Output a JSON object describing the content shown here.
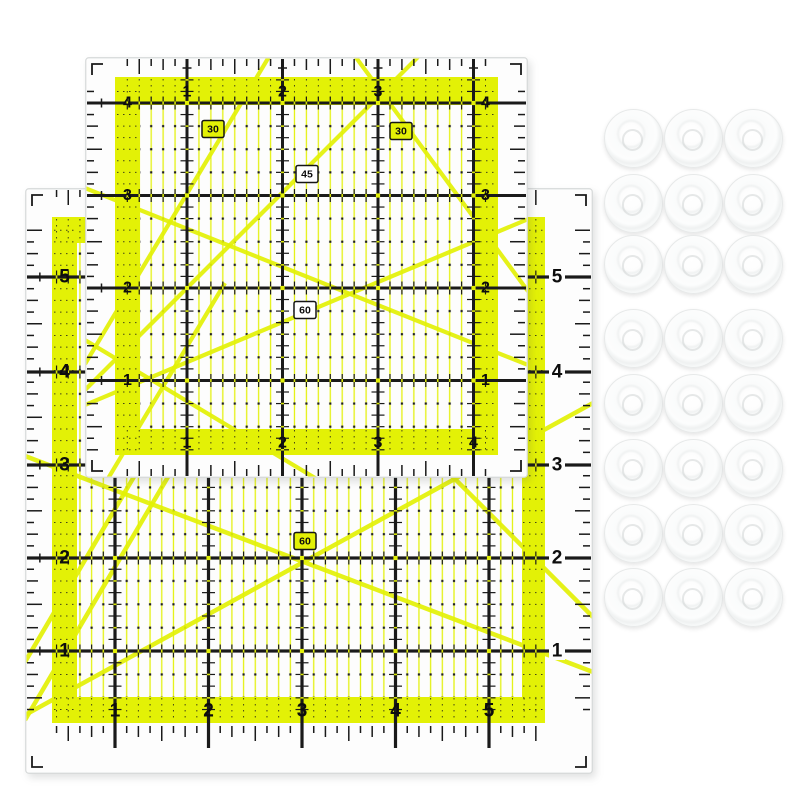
{
  "scene": {
    "width": 800,
    "height": 800,
    "background": "#ffffff",
    "description": "Two neon-yellow acrylic quilting rulers overlapping, with 24 white plastic discs arranged in a 3x8 grid on the right"
  },
  "colors": {
    "neon": "#e3f106",
    "ink": "#1a1a1a",
    "number": "#0d0d0d",
    "body": "#fdfdfd",
    "edge": "#d6d9d9",
    "dot": "#1f1f1f",
    "disc_edge": "#e7e9e9"
  },
  "rulers": [
    {
      "id": "large",
      "name": "large square quilting ruler",
      "pos": {
        "x": 25,
        "y": 188,
        "w": 568,
        "h": 586
      },
      "band": {
        "outer": [
          27,
          29,
          520,
          535
        ],
        "inner": [
          52,
          55,
          497,
          509
        ]
      },
      "grid": {
        "x_lines": [
          90,
          183.5,
          277,
          370.5,
          464
        ],
        "y_lines": [
          89,
          184,
          277,
          370,
          463
        ],
        "eighth_x": 11.69,
        "eighth_y": 11.69
      },
      "labels": {
        "top": [],
        "bottom": [
          "1",
          "2",
          "3",
          "4",
          "5"
        ],
        "left": [
          "5",
          "4",
          "3",
          "2",
          "1"
        ],
        "right": [
          "5",
          "4",
          "3",
          "2",
          "1"
        ],
        "font": 19
      },
      "angle_labels": [
        {
          "text": "60",
          "x": 280,
          "y": 353,
          "yellow": true
        }
      ],
      "diagonals": [
        [
          0,
          268,
          568,
          484
        ],
        [
          0,
          527,
          568,
          215
        ],
        [
          0,
          474,
          170,
          185
        ],
        [
          0,
          532,
          160,
          260
        ],
        [
          300,
          161,
          568,
          429
        ]
      ],
      "line_w": 3.2,
      "diag_w": 4.5,
      "bottom_anchor": "band",
      "right_numbers_x": 532
    },
    {
      "id": "small",
      "name": "small square quilting ruler",
      "pos": {
        "x": 85,
        "y": 57,
        "w": 443,
        "h": 421
      },
      "band": {
        "outer": [
          30,
          20,
          413,
          398
        ],
        "inner": [
          55,
          48,
          388,
          372
        ]
      },
      "grid": {
        "x_lines": [
          102,
          197.5,
          293,
          388.5
        ],
        "y_lines": [
          46,
          138.5,
          231,
          323.5
        ],
        "eighth_x": 11.94,
        "eighth_y": 11.56
      },
      "labels": {
        "top": [
          "1",
          "2",
          "3"
        ],
        "bottom": [
          "1",
          "2",
          "3",
          "4"
        ],
        "left": [
          "4",
          "3",
          "2",
          "1"
        ],
        "right": [
          "4",
          "3",
          "2",
          "1"
        ],
        "font": 16
      },
      "angle_labels": [
        {
          "text": "30",
          "x": 128,
          "y": 72,
          "yellow": true
        },
        {
          "text": "30",
          "x": 316,
          "y": 74,
          "yellow": true
        },
        {
          "text": "45",
          "x": 222,
          "y": 117,
          "yellow": false
        },
        {
          "text": "60",
          "x": 220,
          "y": 253,
          "yellow": false
        }
      ],
      "diagonals": [
        [
          0,
          307,
          200,
          -27
        ],
        [
          250,
          -28,
          448,
          241
        ],
        [
          0,
          333,
          360,
          -27
        ],
        [
          0,
          131,
          448,
          310
        ],
        [
          0,
          348,
          448,
          160
        ],
        [
          0,
          283,
          240,
          427
        ],
        [
          0,
          460,
          140,
          226
        ]
      ],
      "line_w": 3,
      "diag_w": 4.2,
      "bottom_anchor": "edge",
      "right_numbers_x": null
    }
  ],
  "discs": {
    "count": 24,
    "diameter": 57,
    "columns_x": [
      632,
      692,
      752
    ],
    "rows_y": [
      137,
      202,
      263,
      337,
      402,
      467,
      532,
      596
    ]
  }
}
